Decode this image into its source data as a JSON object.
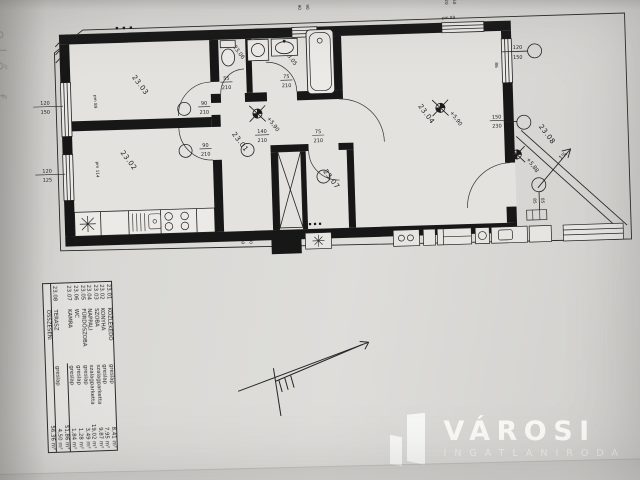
{
  "photo": {
    "edge_text": "elő f"
  },
  "plan": {
    "room_labels": {
      "r1": "23.01",
      "r2": "23.02",
      "r3": "23.03",
      "r4": "23.04",
      "r5": "23.05",
      "r6": "23.06",
      "r7": "23.07",
      "r8": "23.08"
    },
    "levels": {
      "hall": "+5,90",
      "living": "+5,90",
      "terrace": "+5,88"
    },
    "slope_label": "1%",
    "dims": {
      "win_left1_w": "120",
      "win_left1_h": "150",
      "win_left1_pm": "pm 89",
      "win_left2_w": "120",
      "win_left2_h": "125",
      "win_left2_pm": "pm 114",
      "win_top_a": "90",
      "win_top_b": "90",
      "win_topright_a": "120",
      "win_topright_b": "150",
      "win_topright_pm": "pm 89",
      "win_right_w": "120",
      "win_right_h": "150",
      "win_right_side": "86",
      "door_szoba_w": "90",
      "door_szoba_h": "210",
      "door_kitchen_w": "90",
      "door_kitchen_h": "210",
      "door_wc_w": "55",
      "door_wc_h": "210",
      "door_bath_w": "75",
      "door_bath_h": "210",
      "door_kamra_w": "75",
      "door_kamra_h": "210",
      "door_living_w": "140",
      "door_living_h": "210",
      "door_terrace_w": "150",
      "door_terrace_h": "230",
      "terrace_step_a": "85",
      "terrace_step_b": "85",
      "bottom_a": "160",
      "bottom_b": "230",
      "pm_bottom": "pm 96"
    }
  },
  "legend": {
    "rows": [
      {
        "no": "23.01",
        "name": "KÖZLEKEDŐ",
        "floor": "greslap",
        "area": "8,41 m²"
      },
      {
        "no": "23.02",
        "name": "KONYHA",
        "floor": "greslap",
        "area": "7,95 m²"
      },
      {
        "no": "23.03",
        "name": "SZOBA",
        "floor": "szalagparketta",
        "area": "9,87 m²"
      },
      {
        "no": "23.04",
        "name": "NAPPALI",
        "floor": "szalagparketta",
        "area": "19,02 m²"
      },
      {
        "no": "23.05",
        "name": "FÜRDŐSZOBA",
        "floor": "greslap",
        "area": "3,49 m²"
      },
      {
        "no": "23.06",
        "name": "WC",
        "floor": "greslap",
        "area": "1,28 m²"
      },
      {
        "no": "23.07",
        "name": "KAMRA",
        "floor": "greslap",
        "area": "1,84 m²"
      }
    ],
    "subtotal": "51,86 m²",
    "terrace_row": {
      "no": "23.08",
      "name": "TERASZ",
      "floor": "greslap",
      "area": "4,50 m²"
    },
    "total_label": "ÖSSZESEN:",
    "total": "56,36 m²"
  },
  "logo": {
    "title": "VÁROSI",
    "subtitle": "INGATLANIRODA"
  }
}
